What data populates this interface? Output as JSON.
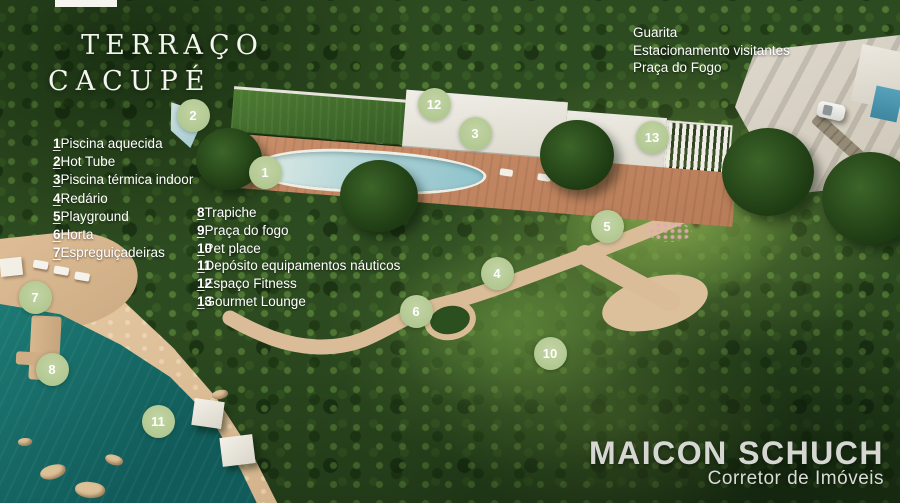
{
  "title": {
    "line1": "TERRAÇO",
    "line2": "CACUPÉ"
  },
  "legend_left": [
    {
      "num": "1",
      "label": "_Piscina aquecida"
    },
    {
      "num": "2",
      "label": "_Hot Tube"
    },
    {
      "num": "3",
      "label": "_Piscina térmica indoor"
    },
    {
      "num": "4",
      "label": "_Redário"
    },
    {
      "num": "5",
      "label": "_Playground"
    },
    {
      "num": "6",
      "label": "_Horta"
    },
    {
      "num": "7",
      "label": "_Espreguiçadeiras"
    }
  ],
  "legend_mid": [
    {
      "num": "8",
      "label": "_Trapiche"
    },
    {
      "num": "9",
      "label": "_Praça do fogo"
    },
    {
      "num": "10",
      "label": "_Pet place"
    },
    {
      "num": "11",
      "label": "_Depósito equipamentos náuticos"
    },
    {
      "num": "12",
      "label": "_Espaço Fitness"
    },
    {
      "num": "13",
      "label": "_Gourmet Lounge"
    }
  ],
  "top_right_labels": [
    "Guarita",
    "Estacionamento visitantes",
    "Praça do Fogo"
  ],
  "markers": [
    {
      "num": "1",
      "x": 265,
      "y": 172
    },
    {
      "num": "2",
      "x": 193,
      "y": 115
    },
    {
      "num": "3",
      "x": 475,
      "y": 133
    },
    {
      "num": "4",
      "x": 497,
      "y": 273
    },
    {
      "num": "5",
      "x": 607,
      "y": 226
    },
    {
      "num": "6",
      "x": 416,
      "y": 311
    },
    {
      "num": "7",
      "x": 35,
      "y": 297
    },
    {
      "num": "8",
      "x": 52,
      "y": 369
    },
    {
      "num": "10",
      "x": 550,
      "y": 353
    },
    {
      "num": "11",
      "x": 158,
      "y": 421
    },
    {
      "num": "12",
      "x": 434,
      "y": 104
    },
    {
      "num": "13",
      "x": 652,
      "y": 137
    }
  ],
  "branding": {
    "name": "MAICON SCHUCH",
    "subtitle": "Corretor de Imóveis"
  },
  "colors": {
    "marker_green": "#b3c993",
    "water_teal": "#156968",
    "text": "#ffffff"
  }
}
